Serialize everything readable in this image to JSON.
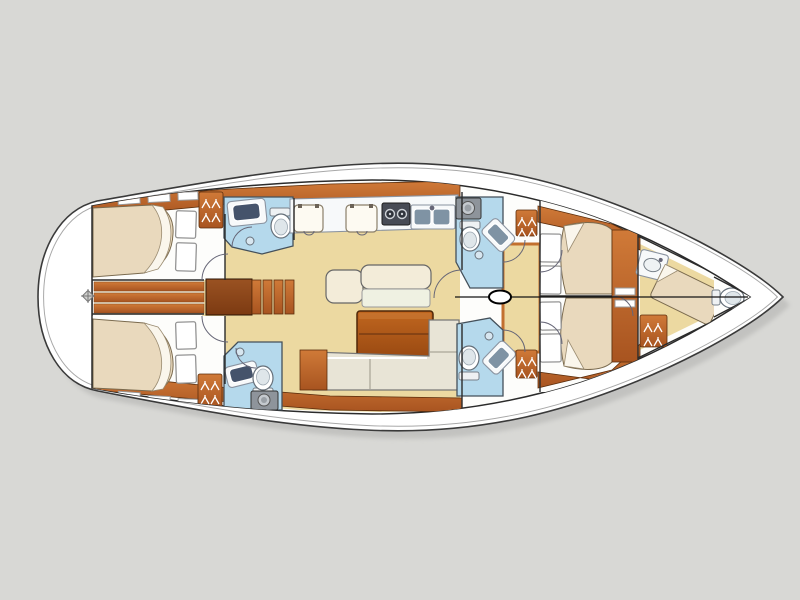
{
  "meta": {
    "type": "yacht-interior-floor-plan",
    "label": "Sailing yacht interior layout plan, bow to the right",
    "orientation": "bow-right"
  },
  "palette": {
    "background": "#d8d8d5",
    "hull_shadow": "#c2c2c0",
    "hull_white": "#ffffff",
    "outline_dark": "#3a3a3a",
    "deck_line": "#a8a8a8",
    "floor_tan": "#ecd9a1",
    "floor_trim_orange": "#c2702f",
    "wood_light": "#cf7433",
    "wood_dark": "#a85420",
    "wood_deep": "#8a4315",
    "bed_cream": "#e9d9bd",
    "blanket_white": "#faf6ec",
    "pillow_white": "#ffffff",
    "head_blue": "#b5d9ec",
    "fixture_white": "#f7f9fa",
    "sink_navy": "#45536b",
    "appliance_gray": "#8e949b",
    "stove_dark": "#474b55",
    "sofa_cream": "#e8e4d6",
    "table_wood": "#b05a1e",
    "wall_line": "#2b2b2b"
  },
  "rooms": [
    {
      "id": "aft-cabin-port",
      "fixtures": [
        "double-berth",
        "pillow",
        "pillow",
        "wardrobe"
      ]
    },
    {
      "id": "aft-head-port",
      "fixtures": [
        "washbasin",
        "toilet",
        "shower"
      ]
    },
    {
      "id": "aft-cabin-starboard",
      "fixtures": [
        "double-berth",
        "pillow",
        "pillow",
        "wardrobe"
      ]
    },
    {
      "id": "aft-head-starboard",
      "fixtures": [
        "washbasin",
        "toilet",
        "shower",
        "top-load-appliance"
      ]
    },
    {
      "id": "aft-corridor",
      "fixtures": [
        "floor-planks",
        "steering-access"
      ]
    },
    {
      "id": "companionway",
      "fixtures": [
        "steps"
      ]
    },
    {
      "id": "galley",
      "fixtures": [
        "cool-box-lid",
        "cool-box-lid",
        "two-burner-stove",
        "double-sink"
      ]
    },
    {
      "id": "saloon",
      "fixtures": [
        "seat",
        "settee",
        "folding-table",
        "u-shaped-sofa",
        "cabinet"
      ]
    },
    {
      "id": "forward-head-port",
      "fixtures": [
        "top-load-appliance",
        "toilet",
        "washbasin",
        "shower"
      ]
    },
    {
      "id": "forward-head-starboard",
      "fixtures": [
        "toilet",
        "washbasin",
        "shower"
      ]
    },
    {
      "id": "forward-corridor",
      "fixtures": [
        "mast"
      ]
    },
    {
      "id": "forward-cabin-port",
      "fixtures": [
        "double-berth",
        "pillow",
        "pillow",
        "wardrobe"
      ]
    },
    {
      "id": "forward-cabin-starboard",
      "fixtures": [
        "double-berth",
        "pillow",
        "pillow",
        "wardrobe"
      ]
    },
    {
      "id": "bow-crew-cabin",
      "fixtures": [
        "berth",
        "washbasin",
        "toilet",
        "wardrobe"
      ]
    }
  ],
  "icons": [
    "hanger-icon",
    "mast-icon",
    "toilet-icon",
    "washbasin-icon",
    "stove-burner-icon",
    "double-sink-icon",
    "shower-icon",
    "steering-access-icon",
    "cool-box-lid-icon",
    "appliance-drum-icon"
  ]
}
